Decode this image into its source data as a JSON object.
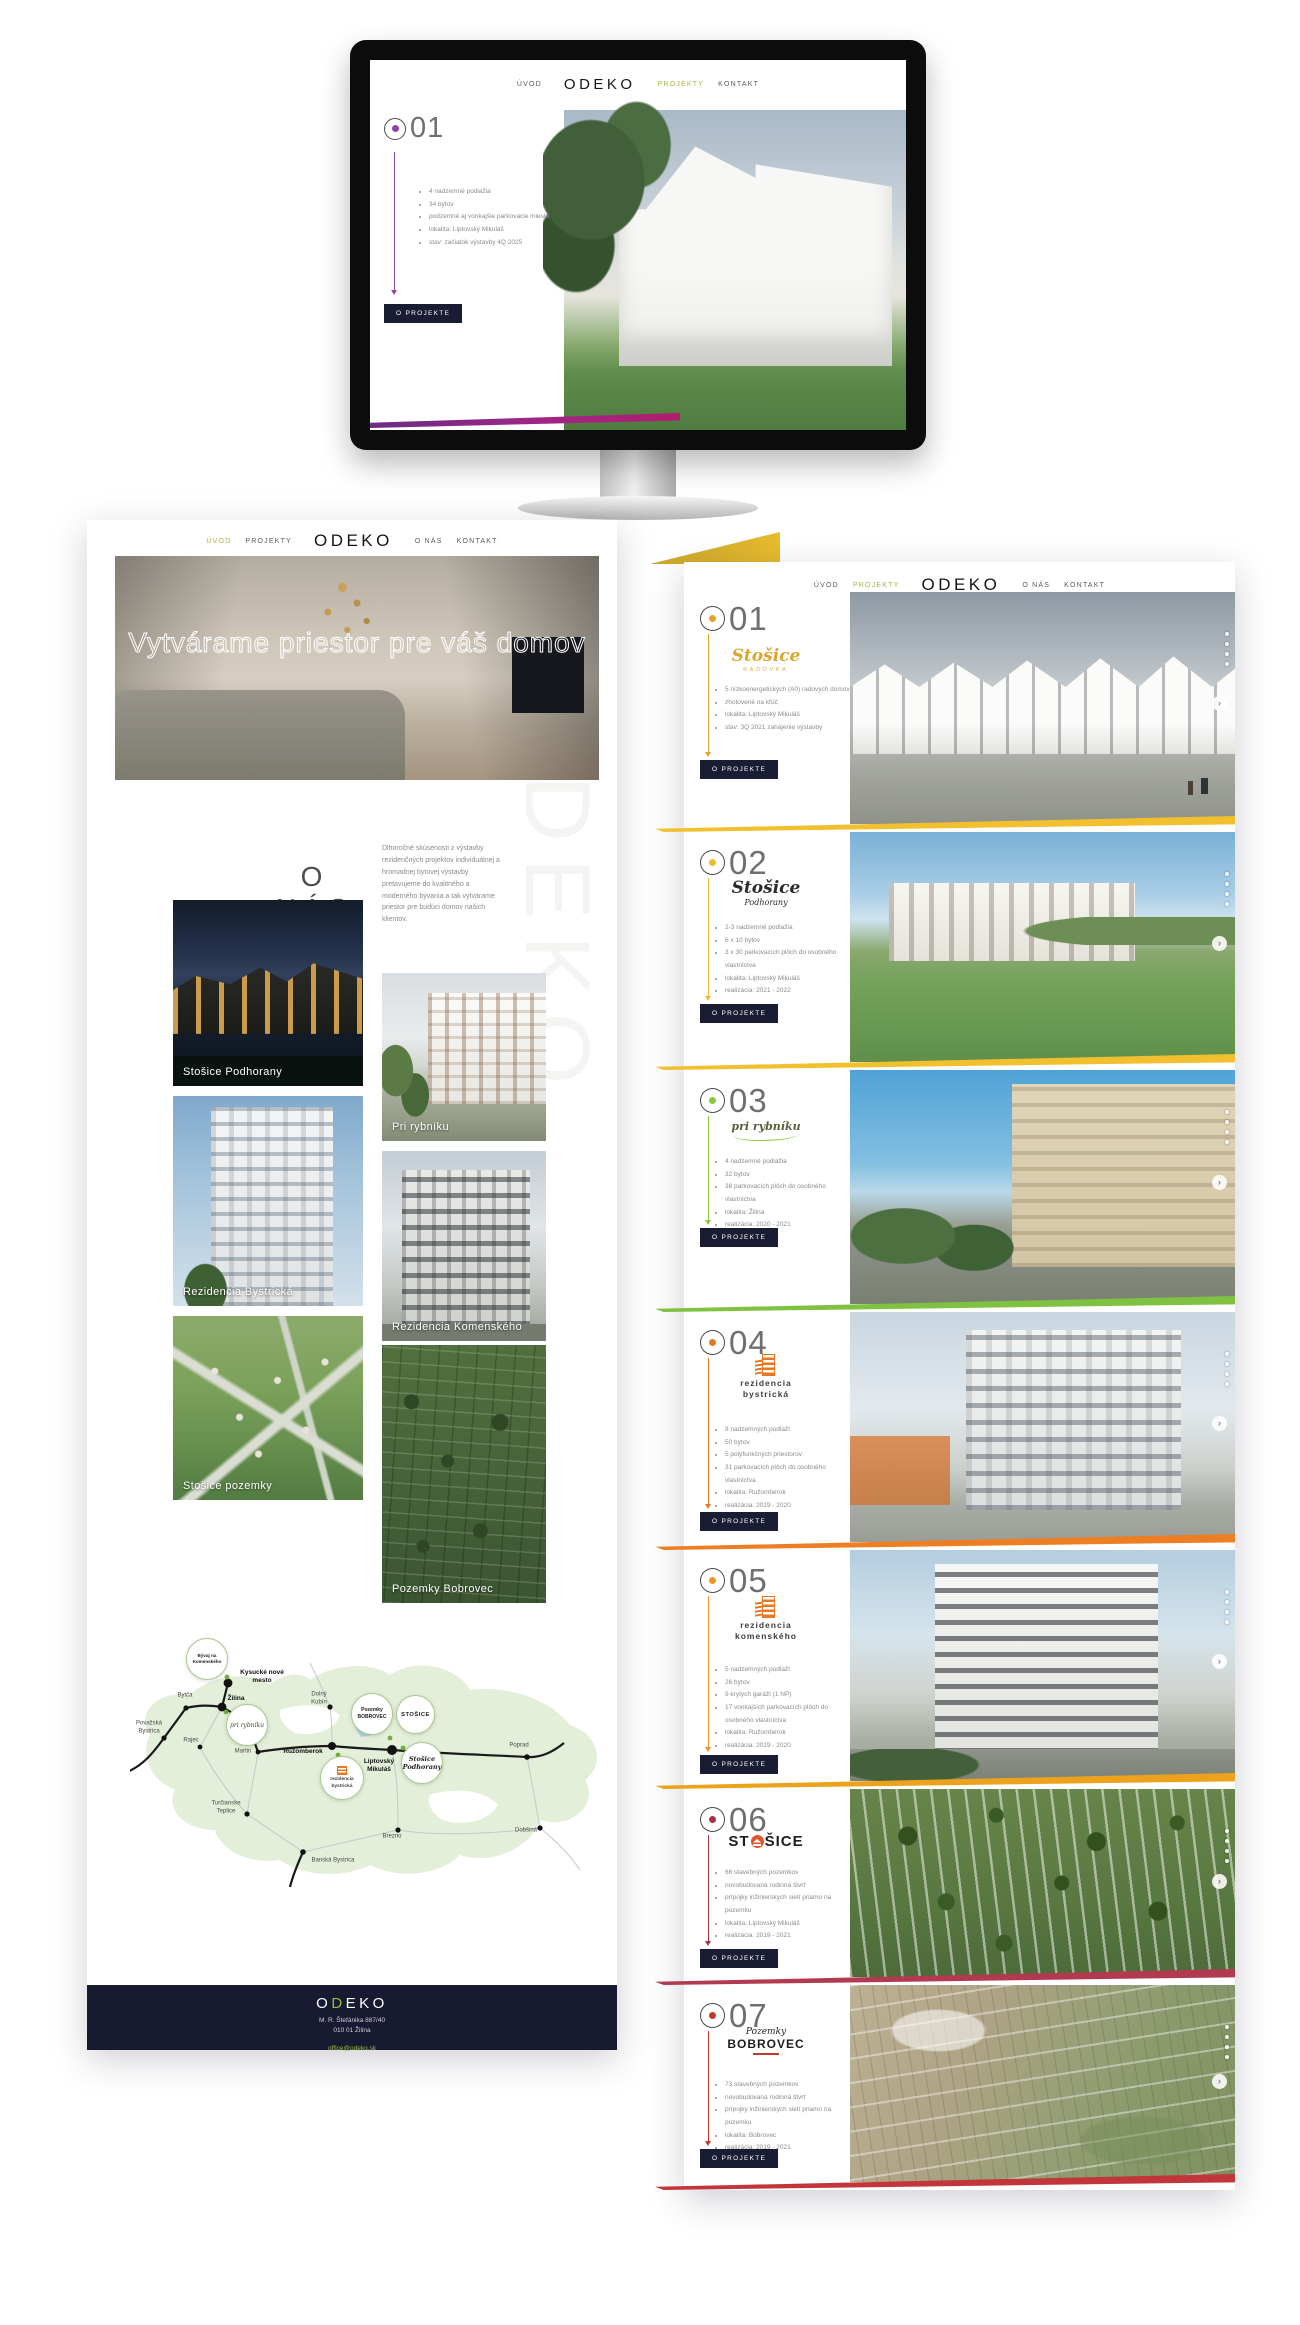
{
  "brand": {
    "logo": "ODEKO",
    "accent_green": "#a9b43c",
    "navy": "#191c33"
  },
  "monitor": {
    "nav": {
      "uvod": "ÚVOD",
      "logo": "ODEKO",
      "projekty": "PROJEKTY",
      "kontakt": "KONTAKT"
    },
    "project": {
      "number": "01",
      "accent": "#8e44ad",
      "bullets": [
        "4 nadzemné podlažia",
        "34 bytov",
        "podzemné aj vonkajšie parkovacie miesta",
        "lokalita: Liptovský Mikuláš",
        "stav: začiatok výstavby 4Q 2025"
      ],
      "button": "O PROJEKTE"
    }
  },
  "left_page": {
    "nav": {
      "uvod": "ÚVOD",
      "projekty": "PROJEKTY",
      "logo": "ODEKO",
      "onas": "O NÁS",
      "kontakt": "KONTAKT"
    },
    "hero_title": "Vytvárame priestor pre váš domov",
    "watermark": "ODEKO",
    "about": {
      "title": "O NÁS",
      "text": "Dlhoročné skúsenosti z výstavby rezidenčných projektov individuálnej a hromadnej bytovej výstavby pretavujeme do kvalitného a moderného bývania a tak vytvárame priestor pre budúci domov našich klientov."
    },
    "gallery": [
      {
        "caption": "Stošice Podhorany"
      },
      {
        "caption": "Pri rybníku"
      },
      {
        "caption": "Rezidencia Bystrická"
      },
      {
        "caption": "Rezidencia Komenského"
      },
      {
        "caption": "Stošice pozemky"
      },
      {
        "caption": "Pozemky Bobrovec"
      }
    ],
    "map": {
      "cities": [
        "Považská Bystrica",
        "Bytča",
        "Žilina",
        "Kysucké nové mesto",
        "Rajec",
        "Martin",
        "Dolný Kubín",
        "Ružomberok",
        "Liptovský Mikuláš",
        "Turčianske Teplice",
        "Banská Bystrica",
        "Brezno",
        "Poprad",
        "Dobšiná"
      ],
      "badges": [
        "Bývaj na Komenského",
        "pri rybníku",
        "Pozemky BOBROVEC",
        "STOŠICE",
        "rezidencia bystrická",
        "Stošice Podhorany"
      ]
    },
    "footer": {
      "logo_o": "O",
      "logo_d": "D",
      "logo_rest": "EKO",
      "address_line1": "M. R. Štefánika 887/40",
      "address_line2": "010 01 Žilina",
      "email": "office@odeko.sk"
    }
  },
  "right_page": {
    "nav": {
      "uvod": "ÚVOD",
      "projekty": "PROJEKTY",
      "logo": "ODEKO",
      "onas": "O NÁS",
      "kontakt": "KONTAKT"
    },
    "button": "O PROJEKTE",
    "projects": [
      {
        "number": "01",
        "accent": "#e2a52d",
        "logo_main": "Stošice",
        "logo_sub": "RADOVKA",
        "bullets": [
          "5 nízkoenergetických (A0) radových domov",
          "zhotovené na kľúč",
          "lokalita: Liptovský Mikuláš",
          "stav: 3Q 2021 zahájenie výstavby"
        ]
      },
      {
        "number": "02",
        "accent": "#eebb2d",
        "logo_main": "Stošice",
        "logo_sub": "Podhorany",
        "bullets": [
          "2-3 nadzemné podlažia",
          "6 x 10 bytov",
          "3 x 30 parkovacích plôch do osobného vlastníctva",
          "lokalita: Liptovský Mikuláš",
          "realizácia: 2021 - 2022"
        ]
      },
      {
        "number": "03",
        "accent": "#8cc63f",
        "logo_main": "pri rybníku",
        "logo_sub": "",
        "bullets": [
          "4 nadzemné podlažia",
          "32 bytov",
          "38 parkovacích plôch do osobného vlastníctva",
          "lokalita: Žilina",
          "realizácia: 2020 - 2021"
        ]
      },
      {
        "number": "04",
        "accent": "#e87722",
        "logo_main": "rezidencia",
        "logo_sub": "bystrická",
        "bullets": [
          "8 nadzemných podlaží",
          "50 bytov",
          "5 polyfunkčných priestorov",
          "31 parkovacích plôch do osobného vlastníctva",
          "lokalita: Ružomberok",
          "realizácia: 2019 - 2020"
        ]
      },
      {
        "number": "05",
        "accent": "#ef9526",
        "logo_main": "rezidencia",
        "logo_sub": "komenského",
        "bullets": [
          "5 nadzemných podlaží",
          "26 bytov",
          "9 krytých garáží (1 NP)",
          "17 vonkajších parkovacích plôch do osobného vlastníctva",
          "lokalita: Ružomberok",
          "realizácia: 2019 - 2020"
        ]
      },
      {
        "number": "06",
        "accent": "#a83246",
        "logo_main": "ST",
        "logo_sub": "ŠICE",
        "bullets": [
          "66 stavebných pozemkov",
          "novobudovaná rodinná štvrť",
          "prípojky inžinierskych sietí priamo na pozemku",
          "lokalita: Liptovský Mikuláš",
          "realizácia: 2019 - 2021"
        ]
      },
      {
        "number": "07",
        "accent": "#c0392b",
        "logo_main": "Pozemky",
        "logo_sub": "BOBROVEC",
        "bullets": [
          "73 stavebných pozemkov",
          "novobudovaná rodinná štvrť",
          "prípojky inžinierskych sietí priamo na pozemku",
          "lokalita: Bobrovec",
          "realizácia: 2019 - 2021"
        ]
      }
    ]
  }
}
